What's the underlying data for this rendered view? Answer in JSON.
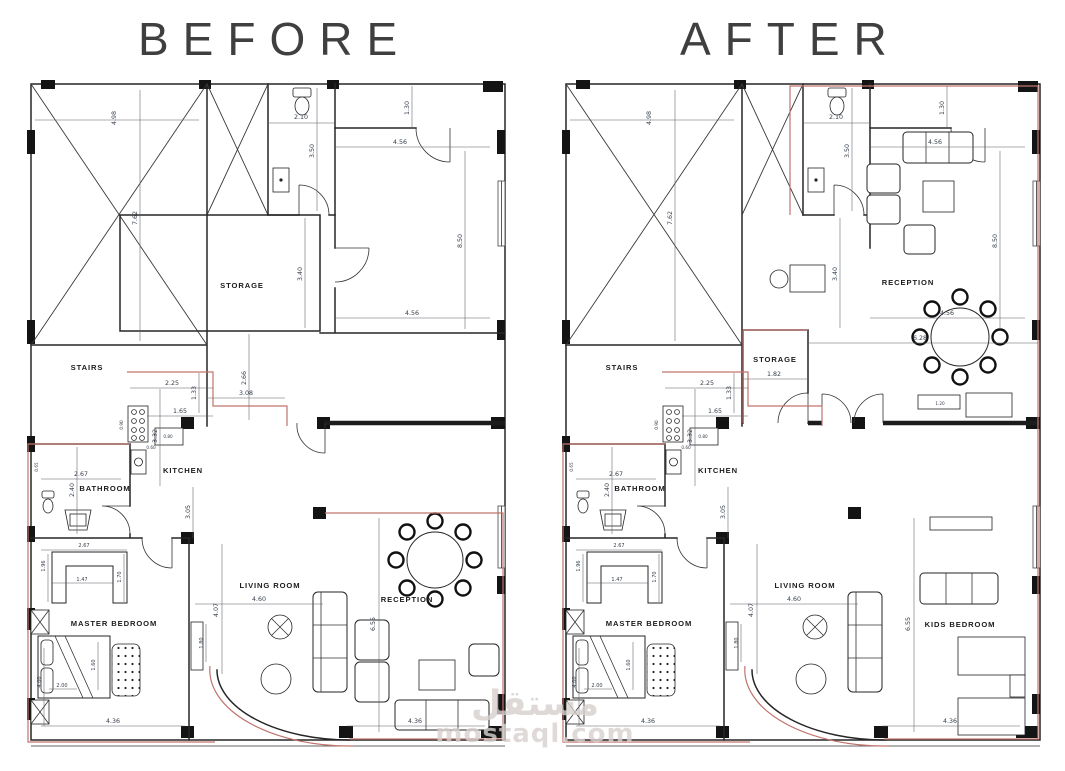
{
  "colors": {
    "wall": "#262626",
    "dim_text": "#353e4b",
    "red_outline": "#c0736b",
    "watermark": "#d6d0cd",
    "background": "#ffffff"
  },
  "watermark": {
    "arabic": "مستقل",
    "latin": "mostaql.com"
  },
  "before": {
    "title": "BEFORE",
    "labels": {
      "stairs": "STAIRS",
      "storage": "STORAGE",
      "kitchen": "KITCHEN",
      "bathroom": "BATHROOM",
      "master_bedroom": "MASTER  BEDROOM",
      "living_room": "LIVING  ROOM",
      "reception": "RECEPTION"
    },
    "dims": {
      "stair_width": "4.98",
      "stair_depth": "7.62",
      "wc_width": "2.10",
      "wc_depth": "3.50",
      "niche": "1.30",
      "hall_top_width": "4.56",
      "hall_depth": "8.50",
      "hall_bottom_width": "4.56",
      "storage_depth": "3.40",
      "hall_width": "3.08",
      "hall_height": "2.66",
      "kitchen_width": "2.25",
      "kitchen_recess": "1.33",
      "counter": "1.65",
      "kitchen_depth": "3.32",
      "kitchen_lower": "3.05",
      "bath_width": "2.67",
      "bath_depth": "2.40",
      "closet_width": "2.67",
      "closet_inner": "1.47",
      "closet_left": "1.96",
      "closet_right": "1.70",
      "bed_length": "1.60",
      "bedroom_depth": "4.00",
      "bed_width": "2.00",
      "bedroom_width": "4.36",
      "living_width": "4.60",
      "living_depth": "4.07",
      "tv_unit": "1.80",
      "reception_depth": "6.55",
      "reception_width": "4.36",
      "burner": "0.90",
      "cabinet": "0.80",
      "sink": "0.60",
      "wc_fix": "0.65"
    }
  },
  "after": {
    "title": "AFTER",
    "labels": {
      "stairs": "STAIRS",
      "storage": "STORAGE",
      "kitchen": "KITCHEN",
      "bathroom": "BATHROOM",
      "master_bedroom": "MASTER  BEDROOM",
      "living_room": "LIVING  ROOM",
      "reception": "RECEPTION",
      "kids_bedroom": "KIDS  BEDROOM"
    },
    "dims": {
      "stair_width": "4.98",
      "stair_depth": "7.62",
      "wc_width": "2.10",
      "wc_depth": "3.50",
      "niche": "1.30",
      "hall_top_width": "4.56",
      "hall_depth": "8.50",
      "hall_bottom_width": "4.56",
      "storage_depth": "3.40",
      "storage_width": "1.82",
      "reception_span": "6.28",
      "cabinet_small": "1.20",
      "kitchen_width": "2.25",
      "kitchen_recess": "1.33",
      "counter": "1.65",
      "kitchen_depth": "3.32",
      "kitchen_lower": "3.05",
      "bath_width": "2.67",
      "bath_depth": "2.40",
      "closet_width": "2.67",
      "closet_inner": "1.47",
      "closet_left": "1.96",
      "closet_right": "1.70",
      "bed_length": "1.60",
      "bedroom_depth": "4.00",
      "bed_width": "2.00",
      "bedroom_width": "4.36",
      "living_width": "4.60",
      "living_depth": "4.07",
      "tv_unit": "1.80",
      "kids_depth": "6.55",
      "kids_width": "4.36",
      "burner": "0.90",
      "cabinet": "0.80",
      "sink": "0.60",
      "wc_fix": "0.65"
    }
  }
}
